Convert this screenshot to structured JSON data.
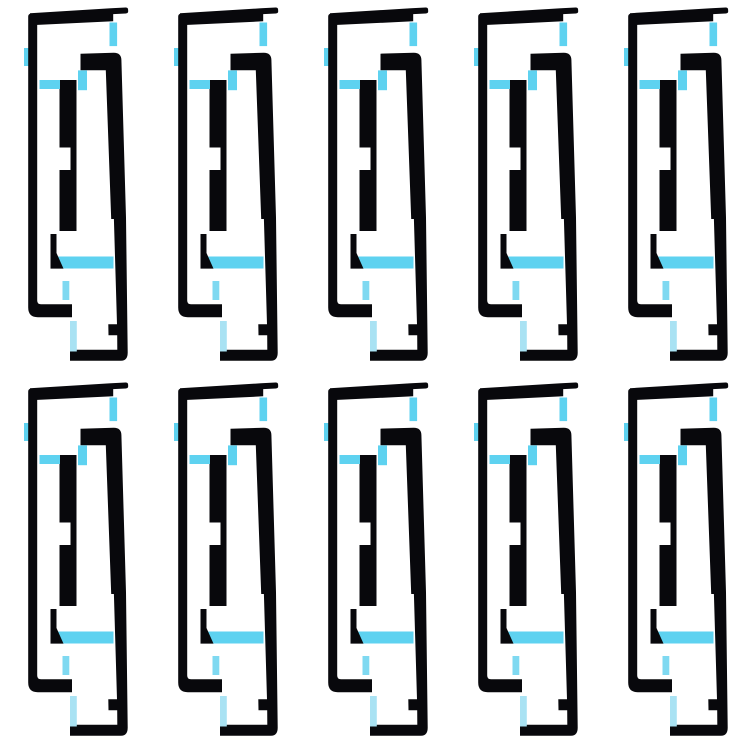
{
  "page": {
    "background_color": "#ffffff"
  },
  "product_photo": {
    "subject": "adhesive-strip-set",
    "grid": {
      "rows": 2,
      "columns": 5,
      "total_items": 10
    },
    "item": {
      "name": "adhesive-strip",
      "parts": [
        "adhesive-top-bar",
        "adhesive-left-rail",
        "adhesive-right-rail",
        "adhesive-center-bar",
        "adhesive-corner-hook",
        "film-tab-left",
        "film-strip-top-right",
        "film-strip-mid-right",
        "film-strip-mid-left",
        "film-bar-lower",
        "film-strip-lower-left",
        "film-strip-bottom"
      ]
    },
    "colors": {
      "background": "#ffffff",
      "adhesive_black": "#08080c",
      "film_blue": "#5ed2f0",
      "film_blue_medium": "#7fd9f1",
      "film_blue_light": "#a9e2f3"
    }
  }
}
